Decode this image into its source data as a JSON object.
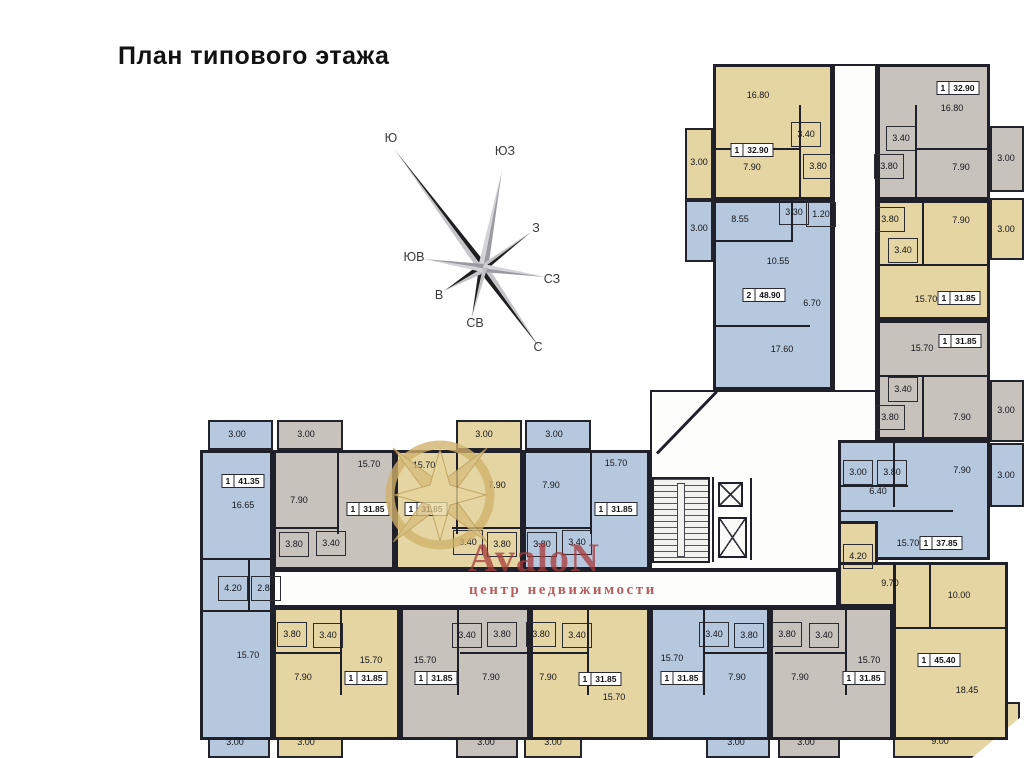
{
  "title": "План типового этажа",
  "watermark": {
    "brand": "AvaloN",
    "subtitle": "центр недвижимости",
    "text_color": "#a83a3a",
    "star_color": "#d8bd7c"
  },
  "compass": {
    "labels": [
      {
        "t": "Ю",
        "x": 391,
        "y": 138
      },
      {
        "t": "ЮЗ",
        "x": 505,
        "y": 151
      },
      {
        "t": "З",
        "x": 536,
        "y": 228
      },
      {
        "t": "СЗ",
        "x": 552,
        "y": 279
      },
      {
        "t": "С",
        "x": 538,
        "y": 347
      },
      {
        "t": "СВ",
        "x": 475,
        "y": 323
      },
      {
        "t": "В",
        "x": 439,
        "y": 295
      },
      {
        "t": "ЮВ",
        "x": 414,
        "y": 257
      }
    ]
  },
  "palette": {
    "wall": "#20202a",
    "yellow": "#e4d5a2",
    "blue": "#b5c8dd",
    "gray": "#c8c2bd",
    "corridor": "#fdfdfc",
    "stair": "#f2f2ef"
  },
  "plan": {
    "corridors": [
      {
        "x": 833,
        "y": 64,
        "w": 44,
        "h": 406
      },
      {
        "x": 650,
        "y": 390,
        "w": 227,
        "h": 180
      },
      {
        "x": 273,
        "y": 570,
        "w": 565,
        "h": 37
      }
    ],
    "apartments": [
      {
        "id": "A1",
        "color": "yellow",
        "rects": [
          [
            713,
            64,
            120,
            136
          ]
        ],
        "badge": {
          "rooms": "1",
          "area": "32.90",
          "x": 752,
          "y": 150
        },
        "labels": [
          [
            "16.80",
            758,
            95,
            0
          ],
          [
            "3.40",
            806,
            134,
            1
          ],
          [
            "7.90",
            752,
            167,
            0
          ],
          [
            "3.80",
            818,
            166,
            1
          ]
        ]
      },
      {
        "id": "A2",
        "color": "blue",
        "rects": [
          [
            713,
            200,
            120,
            190
          ]
        ],
        "badge": {
          "rooms": "2",
          "area": "48.90",
          "x": 764,
          "y": 295
        },
        "labels": [
          [
            "8.55",
            740,
            219,
            0
          ],
          [
            "3.30",
            794,
            212,
            1
          ],
          [
            "1.20",
            821,
            214,
            1
          ],
          [
            "10.55",
            778,
            261,
            0
          ],
          [
            "6.70",
            812,
            303,
            0
          ],
          [
            "17.60",
            782,
            349,
            0
          ]
        ]
      },
      {
        "id": "B1",
        "color": "gray",
        "rects": [
          [
            877,
            64,
            113,
            136
          ]
        ],
        "badge": {
          "rooms": "1",
          "area": "32.90",
          "x": 958,
          "y": 88
        },
        "labels": [
          [
            "16.80",
            952,
            108,
            0
          ],
          [
            "3.40",
            901,
            138,
            1
          ],
          [
            "3.80",
            889,
            166,
            1
          ],
          [
            "7.90",
            961,
            167,
            0
          ]
        ]
      },
      {
        "id": "B2",
        "color": "yellow",
        "rects": [
          [
            877,
            200,
            113,
            120
          ]
        ],
        "badge": {
          "rooms": "1",
          "area": "31.85",
          "x": 959,
          "y": 298
        },
        "labels": [
          [
            "3.80",
            890,
            219,
            1
          ],
          [
            "7.90",
            961,
            220,
            0
          ],
          [
            "3.40",
            903,
            250,
            1
          ],
          [
            "15.70",
            926,
            299,
            0
          ]
        ]
      },
      {
        "id": "B3",
        "color": "gray",
        "rects": [
          [
            877,
            320,
            113,
            120
          ]
        ],
        "badge": {
          "rooms": "1",
          "area": "31.85",
          "x": 960,
          "y": 341
        },
        "labels": [
          [
            "15.70",
            922,
            348,
            0
          ],
          [
            "3.40",
            903,
            389,
            1
          ],
          [
            "3.80",
            890,
            417,
            1
          ],
          [
            "7.90",
            962,
            417,
            0
          ]
        ]
      },
      {
        "id": "B4",
        "color": "blue",
        "rects": [
          [
            838,
            440,
            152,
            120
          ]
        ],
        "badge": {
          "rooms": "1",
          "area": "37.85",
          "x": 941,
          "y": 543
        },
        "labels": [
          [
            "3.00",
            858,
            472,
            1
          ],
          [
            "3.80",
            892,
            472,
            1
          ],
          [
            "7.90",
            962,
            470,
            0
          ],
          [
            "6.40",
            878,
            491,
            0
          ],
          [
            "15.70",
            908,
            543,
            0
          ]
        ]
      },
      {
        "id": "B5",
        "color": "yellow",
        "rects": [
          [
            838,
            521,
            40,
            48
          ],
          [
            838,
            562,
            91,
            45
          ],
          [
            893,
            562,
            115,
            178
          ]
        ],
        "badge": {
          "rooms": "1",
          "area": "45.40",
          "x": 939,
          "y": 660
        },
        "labels": [
          [
            "4.20",
            858,
            556,
            1
          ],
          [
            "9.70",
            890,
            583,
            0
          ],
          [
            "10.00",
            959,
            595,
            0
          ],
          [
            "18.45",
            967,
            690,
            0
          ]
        ]
      },
      {
        "id": "C1",
        "color": "blue",
        "rects": [
          [
            200,
            450,
            73,
            290
          ]
        ],
        "badge": {
          "rooms": "1",
          "area": "41.35",
          "x": 243,
          "y": 481
        },
        "labels": [
          [
            "16.65",
            243,
            505,
            0
          ],
          [
            "4.20",
            233,
            588,
            1
          ],
          [
            "2.80",
            266,
            588,
            1
          ],
          [
            "15.70",
            248,
            655,
            0
          ]
        ]
      },
      {
        "id": "C2",
        "color": "gray",
        "rects": [
          [
            273,
            450,
            122,
            120
          ]
        ],
        "badge": {
          "rooms": "1",
          "area": "31.85",
          "x": 368,
          "y": 509
        },
        "labels": [
          [
            "7.90",
            299,
            500,
            0
          ],
          [
            "15.70",
            369,
            464,
            0
          ],
          [
            "3.80",
            294,
            544,
            1
          ],
          [
            "3.40",
            331,
            543,
            1
          ]
        ]
      },
      {
        "id": "C3",
        "color": "yellow",
        "rects": [
          [
            395,
            450,
            128,
            120
          ]
        ],
        "badge": {
          "rooms": "1",
          "area": "31.85",
          "x": 426,
          "y": 509
        },
        "labels": [
          [
            "15.70",
            424,
            465,
            0
          ],
          [
            "7.90",
            497,
            485,
            0
          ],
          [
            "3.40",
            468,
            542,
            1
          ],
          [
            "3.80",
            502,
            544,
            1
          ]
        ]
      },
      {
        "id": "C4",
        "color": "blue",
        "rects": [
          [
            523,
            450,
            127,
            120
          ]
        ],
        "badge": {
          "rooms": "1",
          "area": "31.85",
          "x": 616,
          "y": 509
        },
        "labels": [
          [
            "7.90",
            551,
            485,
            0
          ],
          [
            "15.70",
            616,
            463,
            0
          ],
          [
            "3.80",
            542,
            544,
            1
          ],
          [
            "3.40",
            577,
            542,
            1
          ]
        ]
      },
      {
        "id": "D2",
        "color": "yellow",
        "rects": [
          [
            273,
            607,
            127,
            133
          ]
        ],
        "badge": {
          "rooms": "1",
          "area": "31.85",
          "x": 366,
          "y": 678
        },
        "labels": [
          [
            "3.80",
            292,
            634,
            1
          ],
          [
            "3.40",
            328,
            635,
            1
          ],
          [
            "7.90",
            303,
            677,
            0
          ],
          [
            "15.70",
            371,
            660,
            0
          ]
        ]
      },
      {
        "id": "D3",
        "color": "gray",
        "rects": [
          [
            400,
            607,
            130,
            133
          ]
        ],
        "badge": {
          "rooms": "1",
          "area": "31.85",
          "x": 436,
          "y": 678
        },
        "labels": [
          [
            "15.70",
            425,
            660,
            0
          ],
          [
            "3.40",
            467,
            635,
            1
          ],
          [
            "3.80",
            502,
            634,
            1
          ],
          [
            "7.90",
            491,
            677,
            0
          ]
        ]
      },
      {
        "id": "D4",
        "color": "yellow",
        "rects": [
          [
            530,
            607,
            120,
            133
          ]
        ],
        "badge": {
          "rooms": "1",
          "area": "31.85",
          "x": 600,
          "y": 679
        },
        "labels": [
          [
            "3.80",
            541,
            634,
            1
          ],
          [
            "3.40",
            577,
            635,
            1
          ],
          [
            "7.90",
            548,
            677,
            0
          ],
          [
            "15.70",
            614,
            697,
            0
          ]
        ]
      },
      {
        "id": "D5",
        "color": "blue",
        "rects": [
          [
            650,
            607,
            120,
            133
          ]
        ],
        "badge": {
          "rooms": "1",
          "area": "31.85",
          "x": 682,
          "y": 678
        },
        "labels": [
          [
            "15.70",
            672,
            658,
            0
          ],
          [
            "3.40",
            714,
            634,
            1
          ],
          [
            "3.80",
            749,
            635,
            1
          ],
          [
            "7.90",
            737,
            677,
            0
          ]
        ]
      },
      {
        "id": "D6",
        "color": "gray",
        "rects": [
          [
            770,
            607,
            123,
            133
          ]
        ],
        "badge": {
          "rooms": "1",
          "area": "31.85",
          "x": 864,
          "y": 678
        },
        "labels": [
          [
            "3.80",
            787,
            634,
            1
          ],
          [
            "3.40",
            824,
            635,
            1
          ],
          [
            "7.90",
            800,
            677,
            0
          ],
          [
            "15.70",
            869,
            660,
            0
          ]
        ]
      }
    ],
    "balconies": [
      {
        "color": "yellow",
        "x": 685,
        "y": 128,
        "w": 28,
        "h": 72,
        "label": "3.00",
        "lx": 699,
        "ly": 162
      },
      {
        "color": "blue",
        "x": 685,
        "y": 200,
        "w": 28,
        "h": 62,
        "label": "3.00",
        "lx": 699,
        "ly": 228
      },
      {
        "color": "gray",
        "x": 990,
        "y": 126,
        "w": 34,
        "h": 66,
        "label": "3.00",
        "lx": 1006,
        "ly": 158
      },
      {
        "color": "yellow",
        "x": 990,
        "y": 198,
        "w": 34,
        "h": 62,
        "label": "3.00",
        "lx": 1006,
        "ly": 229
      },
      {
        "color": "gray",
        "x": 990,
        "y": 380,
        "w": 34,
        "h": 62,
        "label": "3.00",
        "lx": 1006,
        "ly": 410
      },
      {
        "color": "blue",
        "x": 990,
        "y": 443,
        "w": 34,
        "h": 64,
        "label": "3.00",
        "lx": 1006,
        "ly": 475
      },
      {
        "color": "yellow",
        "x": 893,
        "y": 702,
        "w": 127,
        "h": 56,
        "label": "9.00",
        "lx": 940,
        "ly": 741,
        "chamfer": true
      },
      {
        "color": "blue",
        "x": 208,
        "y": 420,
        "w": 65,
        "h": 30,
        "label": "3.00",
        "lx": 237,
        "ly": 434
      },
      {
        "color": "gray",
        "x": 277,
        "y": 420,
        "w": 66,
        "h": 30,
        "label": "3.00",
        "lx": 306,
        "ly": 434
      },
      {
        "color": "yellow",
        "x": 456,
        "y": 420,
        "w": 66,
        "h": 30,
        "label": "3.00",
        "lx": 484,
        "ly": 434
      },
      {
        "color": "blue",
        "x": 525,
        "y": 420,
        "w": 66,
        "h": 30,
        "label": "3.00",
        "lx": 554,
        "ly": 434
      },
      {
        "color": "blue",
        "x": 208,
        "y": 727,
        "w": 62,
        "h": 31,
        "label": "3.00",
        "lx": 235,
        "ly": 742
      },
      {
        "color": "yellow",
        "x": 277,
        "y": 727,
        "w": 66,
        "h": 31,
        "label": "3.00",
        "lx": 306,
        "ly": 742
      },
      {
        "color": "gray",
        "x": 456,
        "y": 727,
        "w": 62,
        "h": 31,
        "label": "3.00",
        "lx": 486,
        "ly": 742
      },
      {
        "color": "yellow",
        "x": 524,
        "y": 727,
        "w": 58,
        "h": 31,
        "label": "3.00",
        "lx": 553,
        "ly": 742
      },
      {
        "color": "blue",
        "x": 706,
        "y": 727,
        "w": 64,
        "h": 31,
        "label": "3.00",
        "lx": 736,
        "ly": 742
      },
      {
        "color": "gray",
        "x": 778,
        "y": 727,
        "w": 62,
        "h": 31,
        "label": "3.00",
        "lx": 806,
        "ly": 742
      }
    ],
    "walls": [
      [
        799,
        105,
        2,
        95
      ],
      [
        715,
        148,
        84,
        2
      ],
      [
        713,
        240,
        80,
        2
      ],
      [
        791,
        200,
        2,
        40
      ],
      [
        713,
        325,
        97,
        2
      ],
      [
        915,
        105,
        2,
        95
      ],
      [
        915,
        148,
        75,
        2
      ],
      [
        877,
        264,
        113,
        2
      ],
      [
        922,
        200,
        2,
        64
      ],
      [
        877,
        375,
        113,
        2
      ],
      [
        922,
        375,
        2,
        65
      ],
      [
        838,
        485,
        70,
        2
      ],
      [
        893,
        440,
        2,
        67
      ],
      [
        838,
        510,
        115,
        2
      ],
      [
        893,
        627,
        114,
        2
      ],
      [
        929,
        562,
        2,
        65
      ],
      [
        200,
        558,
        73,
        2
      ],
      [
        200,
        610,
        73,
        2
      ],
      [
        248,
        560,
        2,
        50
      ],
      [
        337,
        450,
        2,
        84
      ],
      [
        273,
        527,
        64,
        2
      ],
      [
        456,
        450,
        2,
        84
      ],
      [
        452,
        527,
        71,
        2
      ],
      [
        590,
        450,
        2,
        84
      ],
      [
        525,
        527,
        65,
        2
      ],
      [
        340,
        607,
        2,
        88
      ],
      [
        275,
        652,
        65,
        2
      ],
      [
        457,
        607,
        2,
        88
      ],
      [
        460,
        652,
        70,
        2
      ],
      [
        587,
        607,
        2,
        88
      ],
      [
        530,
        652,
        57,
        2
      ],
      [
        703,
        607,
        2,
        88
      ],
      [
        705,
        652,
        65,
        2
      ],
      [
        845,
        607,
        2,
        88
      ],
      [
        775,
        652,
        70,
        2
      ],
      [
        712,
        477,
        2,
        85
      ],
      [
        750,
        478,
        2,
        82
      ]
    ],
    "diagonal": {
      "x": 657,
      "y": 452,
      "w": 86,
      "h": 3,
      "rot": -46
    },
    "stairs": {
      "x": 652,
      "y": 477,
      "w": 58,
      "h": 86
    },
    "elevators": [
      [
        718,
        482,
        25,
        25
      ],
      [
        718,
        517,
        29,
        41
      ]
    ]
  }
}
